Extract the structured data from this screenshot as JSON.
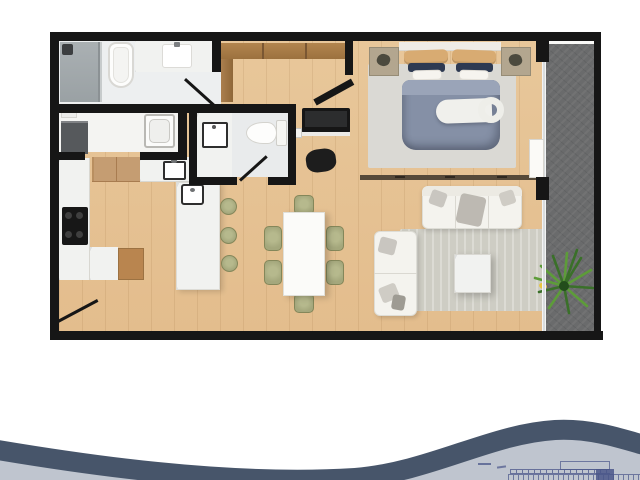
{
  "figure": {
    "kind": "apartment-floor-plan-3d-render",
    "text_labels": [],
    "note": "top-down architectural render; no readable text in plan; tiny illegible blueprint strip bottom-right"
  },
  "palette": {
    "page_bg": "#ffffff",
    "wall": "#161616",
    "wood": "#e8c79a",
    "marble": "#f1f2f0",
    "bath_floor": "#edeff0",
    "utility_floor": "#f4f4f2",
    "bath2_floor": "#e9ebec",
    "shower": "#a3a9ac",
    "balcony": "#6a6b6c",
    "glass": "#ccd0d2",
    "rug_bedroom": "#dad9d4",
    "rug_living": "#cecdc4",
    "duvet": "#8590a6",
    "duvet_fold": "#9aa4b8",
    "headboard": "#efece6",
    "pillow_white": "#f6f4ef",
    "pillow_tan": "#d8ab72",
    "pillow_navy": "#2e3a52",
    "nightstand": "#b3a68f",
    "closet_wood": "#a87c50",
    "sofa": "#f4f3ee",
    "cushion_gray": "#c9c6c0",
    "table_white": "#fbfbf9",
    "chair_green": "#a4a77c",
    "cooktop": "#171717",
    "appliance_dark": "#56595c",
    "fridge_wood": "#c59d72",
    "cart_wood": "#b9854f",
    "plant_dark": "#3a7029",
    "plant_light": "#5d9c39",
    "flower_yellow": "#e9c63e",
    "wave_dark": "#47556a",
    "wave_light": "#bfc5cf",
    "ink": "#4a568a"
  },
  "footer": {
    "wave_band_stroke_px": 20,
    "mini_drawing": "illegible micro blueprint strip, navy ink on light gray"
  }
}
